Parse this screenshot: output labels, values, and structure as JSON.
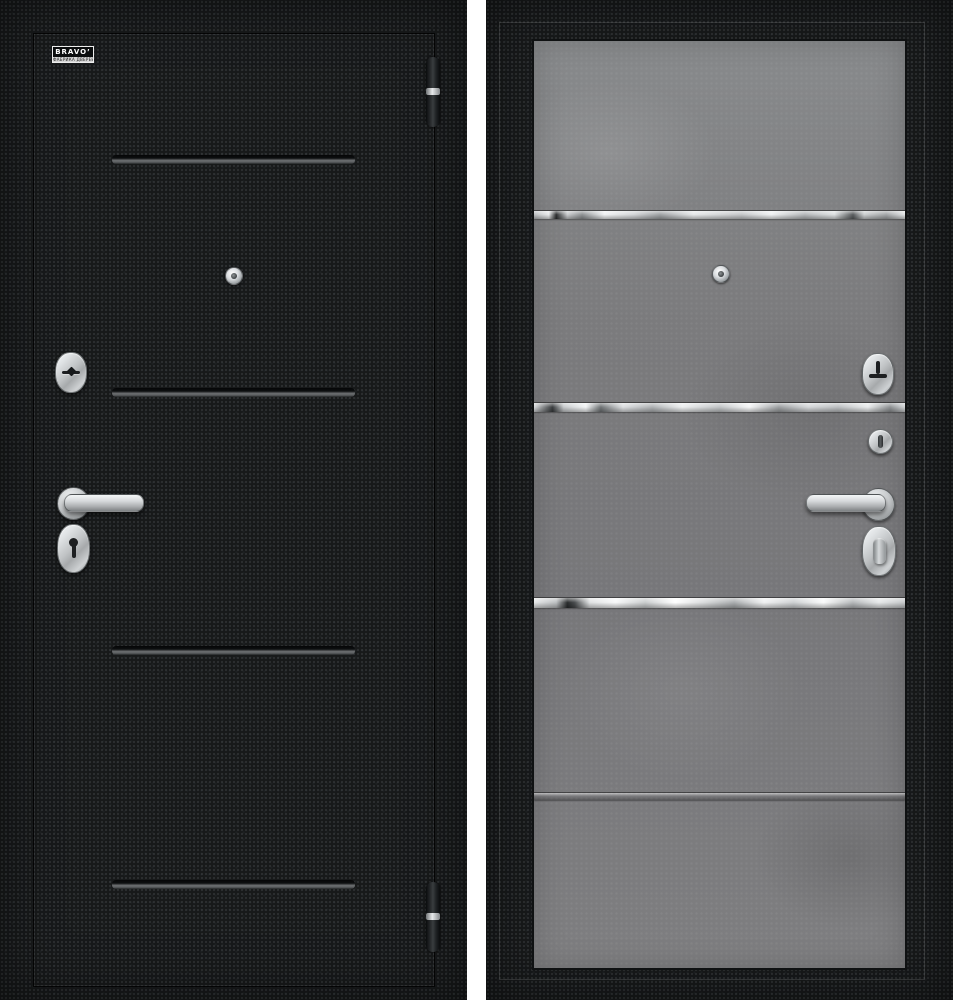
{
  "page": {
    "background_color": "#ffffff"
  },
  "brand": {
    "logo_text": "BRAVO’",
    "logo_tagline": "ФАБРИКА ДВЕРЕЙ"
  },
  "product": {
    "views": [
      {
        "id": "exterior-black",
        "finish_color": "#17191a",
        "groove_count": 4,
        "hardware": [
          "peephole",
          "keyhole-escutcheon",
          "lever-handle",
          "cylinder-keyhole-escutcheon",
          "hinge-top",
          "hinge-bottom"
        ]
      },
      {
        "id": "interior-concrete",
        "finish_color": "#7d7d7f",
        "mirror_strip_count": 4,
        "hardware": [
          "peephole",
          "keyhole-escutcheon",
          "thumbturn",
          "lever-handle",
          "latch-knob-escutcheon"
        ]
      }
    ],
    "colors": {
      "chrome": "#c9ccce",
      "mirror_strip": "#dfe1e3",
      "frame_black": "#17191a",
      "concrete_grey": "#7d7d7f",
      "gap_white": "#ffffff"
    }
  }
}
